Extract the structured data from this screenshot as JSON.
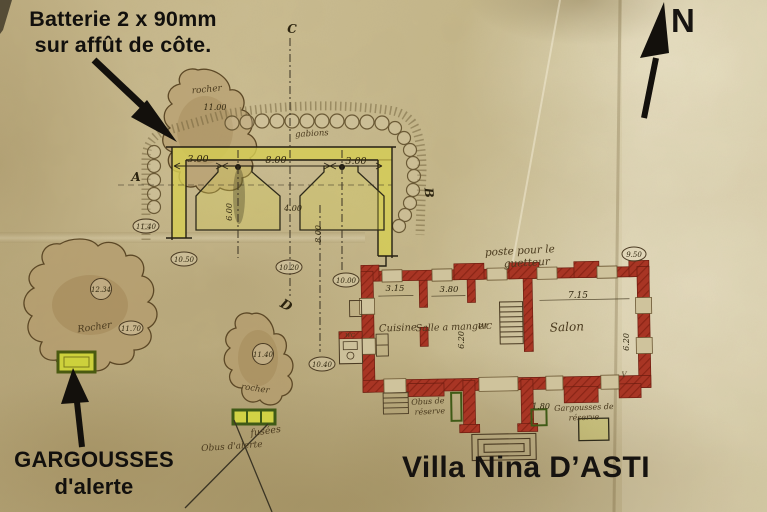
{
  "overlay": {
    "battery_note": {
      "line1": "Batterie 2 x 90mm",
      "line2": "sur affût de côte."
    },
    "gargousses_note": {
      "line1": "GARGOUSSES",
      "line2": "d'alerte"
    },
    "villa_title": "Villa Nina D’ASTI",
    "compass_n": "N"
  },
  "plan": {
    "battery": {
      "gabions_label": "gabions",
      "letters": {
        "a": "A",
        "b": "B",
        "c": "C",
        "d": "D"
      },
      "dims": {
        "w_left": "3.00",
        "w_mid": "8.00",
        "w_right": "3.00",
        "d_left": "6.00",
        "d_mid": "4.00",
        "d_axis": "8.00"
      }
    },
    "rocks": {
      "top": {
        "label": "rocher",
        "elev": "11.00"
      },
      "left": {
        "label": "Rocher",
        "spot": "12.34",
        "elev": "11.70"
      },
      "mid": {
        "label": "rocher",
        "spot": "11.40"
      }
    },
    "elevations": {
      "e1140": "11.40",
      "e1050": "10.50",
      "e1020": "10.20",
      "e1000": "10.00",
      "e1040": "10.40",
      "e950": "9.50"
    },
    "villa": {
      "guard_note": {
        "line1": "poste pour le",
        "line2": "guetteur"
      },
      "rooms": {
        "kitchen": "Cuisine",
        "dining": "Salle a manger",
        "wc": "WC",
        "wc_annex": "WC",
        "salon": "Salon"
      },
      "dims": {
        "kitchen_w": "3.15",
        "dining_w": "3.80",
        "salon_w": "7.15",
        "depth_mid": "6.20",
        "depth_right": "6.20",
        "porch": "1.80"
      },
      "stores": {
        "obus_reserve": {
          "line1": "Obus de",
          "line2": "réserve"
        },
        "gargousses_reserve": {
          "line1": "Gargousses de",
          "line2": "réserve"
        },
        "fusees": "fusées",
        "obus_alerte": "Obus d'alerte"
      },
      "mark_v": "V"
    }
  },
  "colors": {
    "paper": "#c8ba8f",
    "wall_red": "#a83524",
    "highlight_yellow": "#d5cd54",
    "store_green": "#3f5a16",
    "ink": "#171411",
    "hand_ink": "#4a3a1e"
  }
}
